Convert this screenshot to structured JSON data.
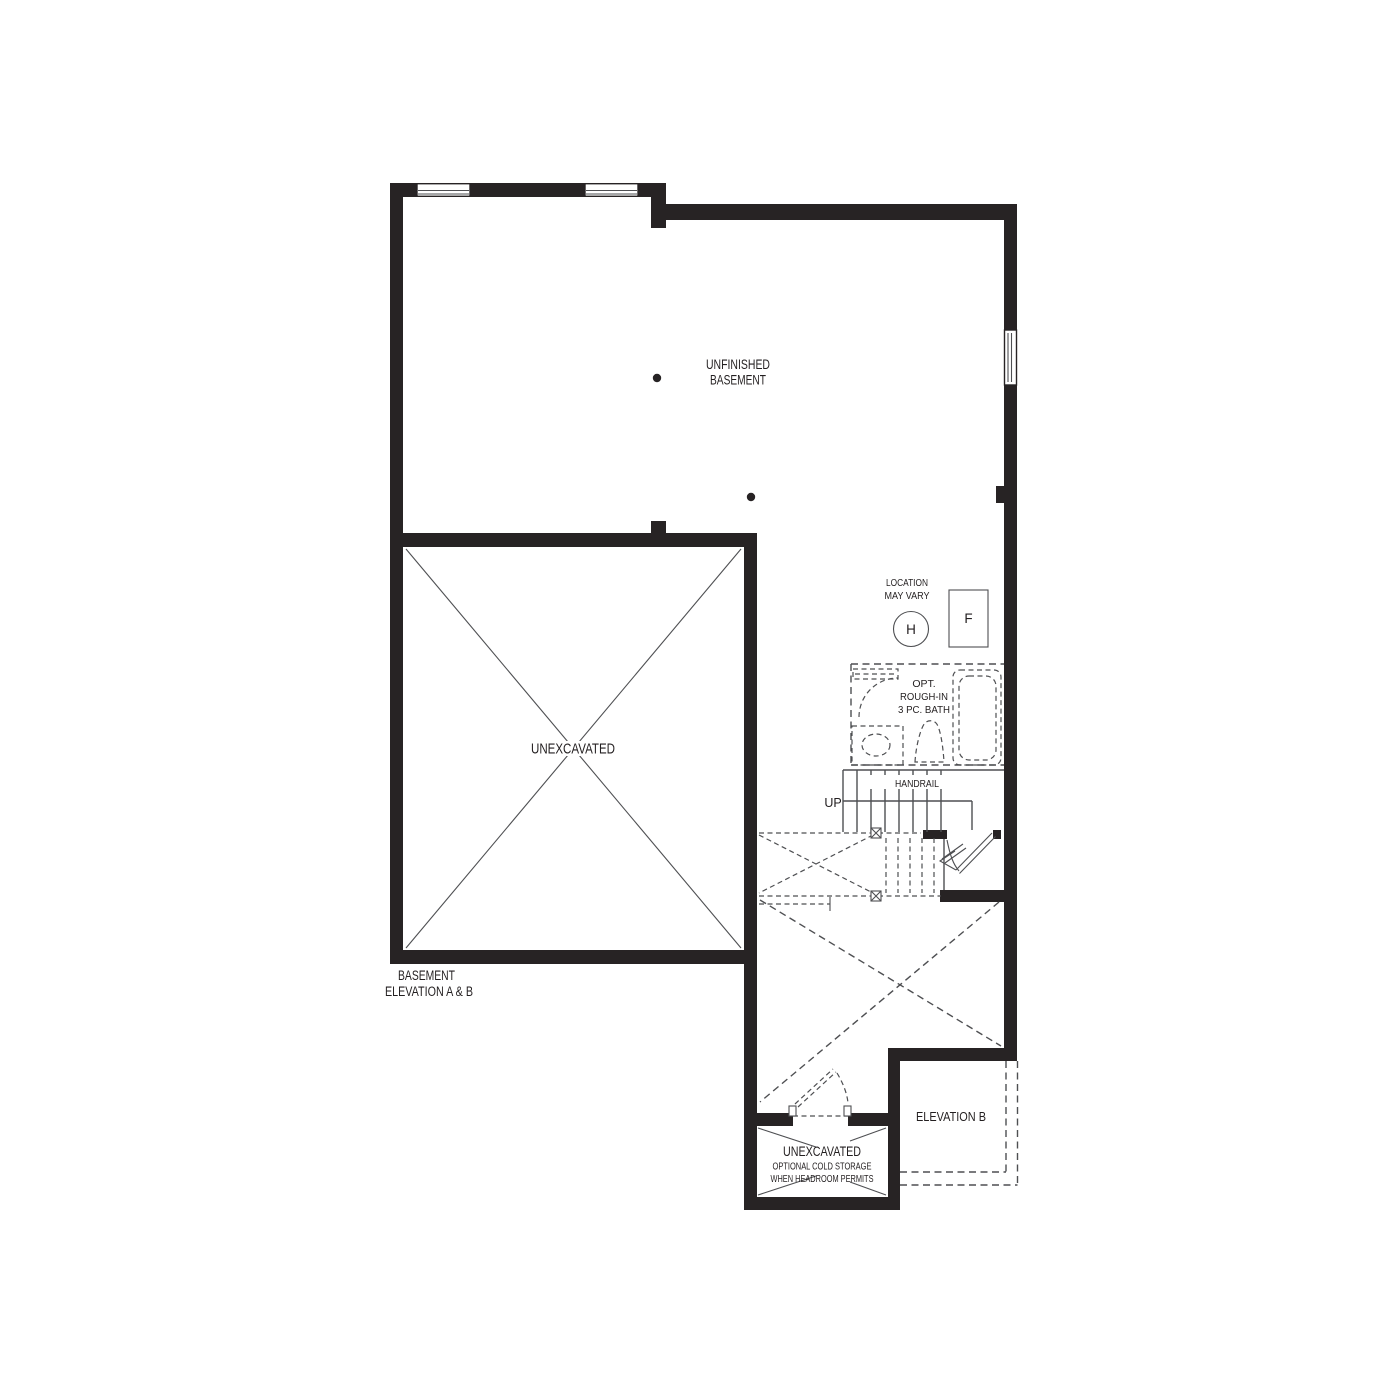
{
  "colors": {
    "wall": "#272324",
    "thin_line": "#4e4f52",
    "text": "#231f20",
    "background": "#ffffff"
  },
  "labels": {
    "unfinished_basement": {
      "line1": "UNFINISHED",
      "line2": "BASEMENT"
    },
    "location_note": {
      "line1": "LOCATION",
      "line2": "MAY VARY"
    },
    "hot_water_tank_symbol": "H",
    "furnace_symbol": "F",
    "bath_note": {
      "line1": "OPT.",
      "line2": "ROUGH-IN",
      "line3": "3 PC. BATH"
    },
    "handrail": "HANDRAIL",
    "up": "UP",
    "unexcavated_main": "UNEXCAVATED",
    "plan_title": {
      "line1": "BASEMENT",
      "line2": "ELEVATION A & B"
    },
    "cold_storage": {
      "line1": "UNEXCAVATED",
      "line2": "OPTIONAL COLD STORAGE",
      "line3": "WHEN HEADROOM PERMITS"
    },
    "elevation_b": "ELEVATION  B"
  }
}
